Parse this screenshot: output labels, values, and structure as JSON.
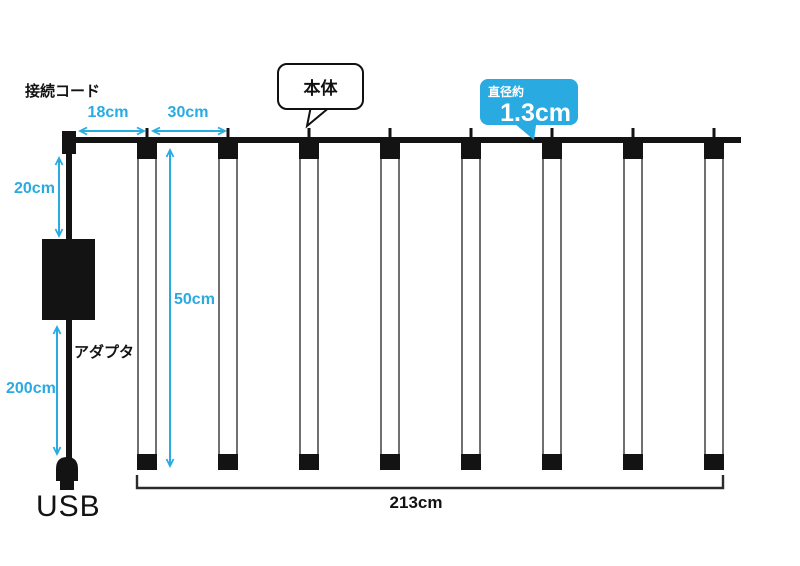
{
  "diagram": {
    "labels": {
      "connection_cord": "接続コード",
      "main_body": "本体",
      "diameter_label": "直径約",
      "diameter_value": "1.3cm",
      "adapter": "アダプタ",
      "usb": "USB"
    },
    "measurements": {
      "end_to_first_tube": "18cm",
      "tube_spacing": "30cm",
      "top_cord": "20cm",
      "tube_length": "50cm",
      "bottom_cord": "200cm",
      "total_width": "213cm"
    },
    "tube_count": 8,
    "colors": {
      "accent_cyan": "#29ABE2",
      "line_black": "#131313"
    }
  }
}
